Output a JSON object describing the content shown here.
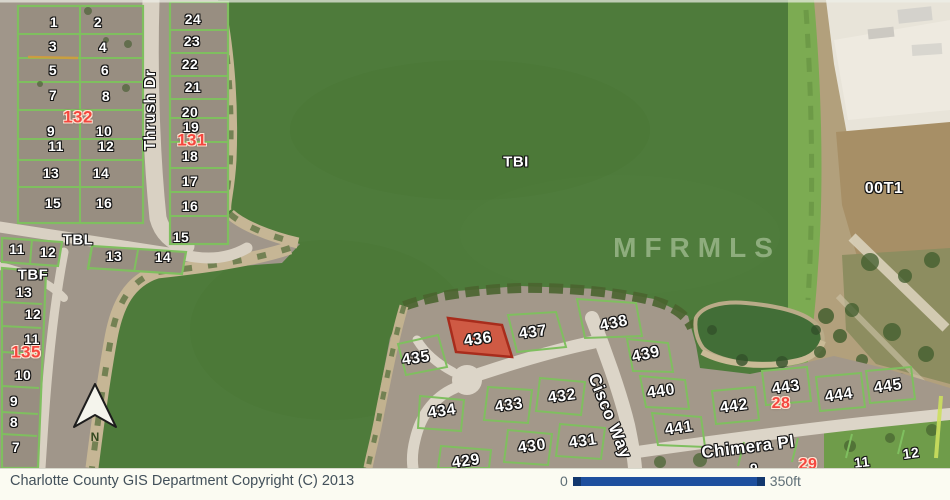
{
  "map": {
    "highlight": {
      "lot": "436",
      "fill": "#cf5a44",
      "border": "#a82c1c"
    },
    "labels": [
      {
        "text": "1",
        "x": 54,
        "y": 22,
        "kind": "lot",
        "size": 14
      },
      {
        "text": "2",
        "x": 98,
        "y": 22,
        "kind": "lot",
        "size": 14
      },
      {
        "text": "3",
        "x": 53,
        "y": 46,
        "kind": "lot",
        "size": 14
      },
      {
        "text": "4",
        "x": 103,
        "y": 47,
        "kind": "lot",
        "size": 14
      },
      {
        "text": "5",
        "x": 53,
        "y": 70,
        "kind": "lot",
        "size": 14
      },
      {
        "text": "6",
        "x": 105,
        "y": 70,
        "kind": "lot",
        "size": 14
      },
      {
        "text": "7",
        "x": 53,
        "y": 95,
        "kind": "lot",
        "size": 14
      },
      {
        "text": "8",
        "x": 106,
        "y": 96,
        "kind": "lot",
        "size": 14
      },
      {
        "text": "132",
        "x": 78,
        "y": 117,
        "kind": "red",
        "size": 17
      },
      {
        "text": "9",
        "x": 51,
        "y": 131,
        "kind": "lot",
        "size": 14
      },
      {
        "text": "10",
        "x": 104,
        "y": 131,
        "kind": "lot",
        "size": 14
      },
      {
        "text": "11",
        "x": 56,
        "y": 146,
        "kind": "lot",
        "size": 14
      },
      {
        "text": "12",
        "x": 106,
        "y": 146,
        "kind": "lot",
        "size": 14
      },
      {
        "text": "13",
        "x": 51,
        "y": 173,
        "kind": "lot",
        "size": 14
      },
      {
        "text": "14",
        "x": 101,
        "y": 173,
        "kind": "lot",
        "size": 14
      },
      {
        "text": "15",
        "x": 53,
        "y": 203,
        "kind": "lot",
        "size": 14
      },
      {
        "text": "16",
        "x": 104,
        "y": 203,
        "kind": "lot",
        "size": 14
      },
      {
        "text": "24",
        "x": 193,
        "y": 19,
        "kind": "lot",
        "size": 14
      },
      {
        "text": "23",
        "x": 192,
        "y": 41,
        "kind": "lot",
        "size": 14
      },
      {
        "text": "22",
        "x": 190,
        "y": 64,
        "kind": "lot",
        "size": 14
      },
      {
        "text": "21",
        "x": 193,
        "y": 87,
        "kind": "lot",
        "size": 14
      },
      {
        "text": "20",
        "x": 190,
        "y": 112,
        "kind": "lot",
        "size": 14
      },
      {
        "text": "19",
        "x": 191,
        "y": 127,
        "kind": "lot",
        "size": 14
      },
      {
        "text": "131",
        "x": 192,
        "y": 140,
        "kind": "red",
        "size": 17
      },
      {
        "text": "18",
        "x": 190,
        "y": 156,
        "kind": "lot",
        "size": 14
      },
      {
        "text": "17",
        "x": 190,
        "y": 181,
        "kind": "lot",
        "size": 14
      },
      {
        "text": "16",
        "x": 190,
        "y": 206,
        "kind": "lot",
        "size": 14
      },
      {
        "text": "15",
        "x": 181,
        "y": 237,
        "kind": "lot",
        "size": 14
      },
      {
        "text": "14",
        "x": 163,
        "y": 257,
        "kind": "lot",
        "size": 14
      },
      {
        "text": "13",
        "x": 114,
        "y": 256,
        "kind": "lot",
        "size": 14
      },
      {
        "text": "Thrush Dr",
        "x": 151,
        "y": 110,
        "kind": "street",
        "size": 16,
        "rot": -90
      },
      {
        "text": "TBL",
        "x": 78,
        "y": 240,
        "kind": "area",
        "size": 15
      },
      {
        "text": "11",
        "x": 17,
        "y": 249,
        "kind": "lot",
        "size": 14
      },
      {
        "text": "12",
        "x": 48,
        "y": 252,
        "kind": "lot",
        "size": 14
      },
      {
        "text": "TBF",
        "x": 33,
        "y": 275,
        "kind": "area",
        "size": 15
      },
      {
        "text": "13",
        "x": 24,
        "y": 292,
        "kind": "lot",
        "size": 14
      },
      {
        "text": "12",
        "x": 33,
        "y": 314,
        "kind": "lot",
        "size": 14
      },
      {
        "text": "11",
        "x": 32,
        "y": 339,
        "kind": "lot",
        "size": 14
      },
      {
        "text": "135",
        "x": 26,
        "y": 352,
        "kind": "red",
        "size": 17
      },
      {
        "text": "10",
        "x": 23,
        "y": 375,
        "kind": "lot",
        "size": 14
      },
      {
        "text": "9",
        "x": 14,
        "y": 401,
        "kind": "lot",
        "size": 14
      },
      {
        "text": "8",
        "x": 14,
        "y": 422,
        "kind": "lot",
        "size": 14
      },
      {
        "text": "7",
        "x": 16,
        "y": 447,
        "kind": "lot",
        "size": 14
      },
      {
        "text": "TBI",
        "x": 516,
        "y": 162,
        "kind": "area",
        "size": 15
      },
      {
        "text": "MFRMLS",
        "x": 697,
        "y": 248,
        "kind": "watermark",
        "size": 28
      },
      {
        "text": "00T1",
        "x": 884,
        "y": 189,
        "kind": "area",
        "size": 16
      },
      {
        "text": "435",
        "x": 416,
        "y": 359,
        "kind": "lot",
        "size": 16,
        "rot": -8
      },
      {
        "text": "436",
        "x": 478,
        "y": 340,
        "kind": "lot",
        "size": 16,
        "rot": -8
      },
      {
        "text": "437",
        "x": 533,
        "y": 333,
        "kind": "lot",
        "size": 16,
        "rot": -8
      },
      {
        "text": "438",
        "x": 614,
        "y": 324,
        "kind": "lot",
        "size": 16,
        "rot": -12
      },
      {
        "text": "439",
        "x": 646,
        "y": 355,
        "kind": "lot",
        "size": 16,
        "rot": -12
      },
      {
        "text": "440",
        "x": 661,
        "y": 392,
        "kind": "lot",
        "size": 16,
        "rot": -8
      },
      {
        "text": "441",
        "x": 679,
        "y": 429,
        "kind": "lot",
        "size": 16,
        "rot": -8
      },
      {
        "text": "442",
        "x": 734,
        "y": 407,
        "kind": "lot",
        "size": 16,
        "rot": -8
      },
      {
        "text": "443",
        "x": 786,
        "y": 388,
        "kind": "lot",
        "size": 16,
        "rot": -8
      },
      {
        "text": "28",
        "x": 781,
        "y": 404,
        "kind": "red",
        "size": 16
      },
      {
        "text": "444",
        "x": 839,
        "y": 396,
        "kind": "lot",
        "size": 16,
        "rot": -8
      },
      {
        "text": "445",
        "x": 888,
        "y": 387,
        "kind": "lot",
        "size": 16,
        "rot": -8
      },
      {
        "text": "432",
        "x": 562,
        "y": 397,
        "kind": "lot",
        "size": 16,
        "rot": -8
      },
      {
        "text": "433",
        "x": 509,
        "y": 406,
        "kind": "lot",
        "size": 16,
        "rot": -8
      },
      {
        "text": "434",
        "x": 442,
        "y": 412,
        "kind": "lot",
        "size": 16,
        "rot": -8
      },
      {
        "text": "431",
        "x": 583,
        "y": 442,
        "kind": "lot",
        "size": 16,
        "rot": -8
      },
      {
        "text": "430",
        "x": 532,
        "y": 447,
        "kind": "lot",
        "size": 16,
        "rot": -8
      },
      {
        "text": "429",
        "x": 466,
        "y": 462,
        "kind": "lot",
        "size": 16,
        "rot": -8
      },
      {
        "text": "Cisco Way",
        "x": 610,
        "y": 416,
        "kind": "street",
        "size": 17,
        "rot": 68
      },
      {
        "text": "Chimera Pl",
        "x": 748,
        "y": 447,
        "kind": "street",
        "size": 17,
        "rot": -7
      },
      {
        "text": "9",
        "x": 754,
        "y": 468,
        "kind": "lot",
        "size": 14
      },
      {
        "text": "29",
        "x": 808,
        "y": 465,
        "kind": "red",
        "size": 16
      },
      {
        "text": "11",
        "x": 862,
        "y": 462,
        "kind": "lot",
        "size": 14,
        "rot": -6
      },
      {
        "text": "12",
        "x": 911,
        "y": 453,
        "kind": "lot",
        "size": 14,
        "rot": -8
      },
      {
        "text": "N",
        "x": 95,
        "y": 437,
        "kind": "north",
        "size": 12
      }
    ]
  },
  "footer": {
    "copyright": "Charlotte County GIS Department Copyright (C) 2013",
    "scale": {
      "start": "0",
      "end": "350ft"
    }
  },
  "colors": {
    "water": "#4e7b3b",
    "lot_line": "#7fbf5f",
    "road": "#d9d1c3",
    "highlight_fill": "#cf5a44",
    "highlight_border": "#a82c1c",
    "scalebar_blue": "#1e4f9e",
    "footer_text": "#42505a"
  }
}
